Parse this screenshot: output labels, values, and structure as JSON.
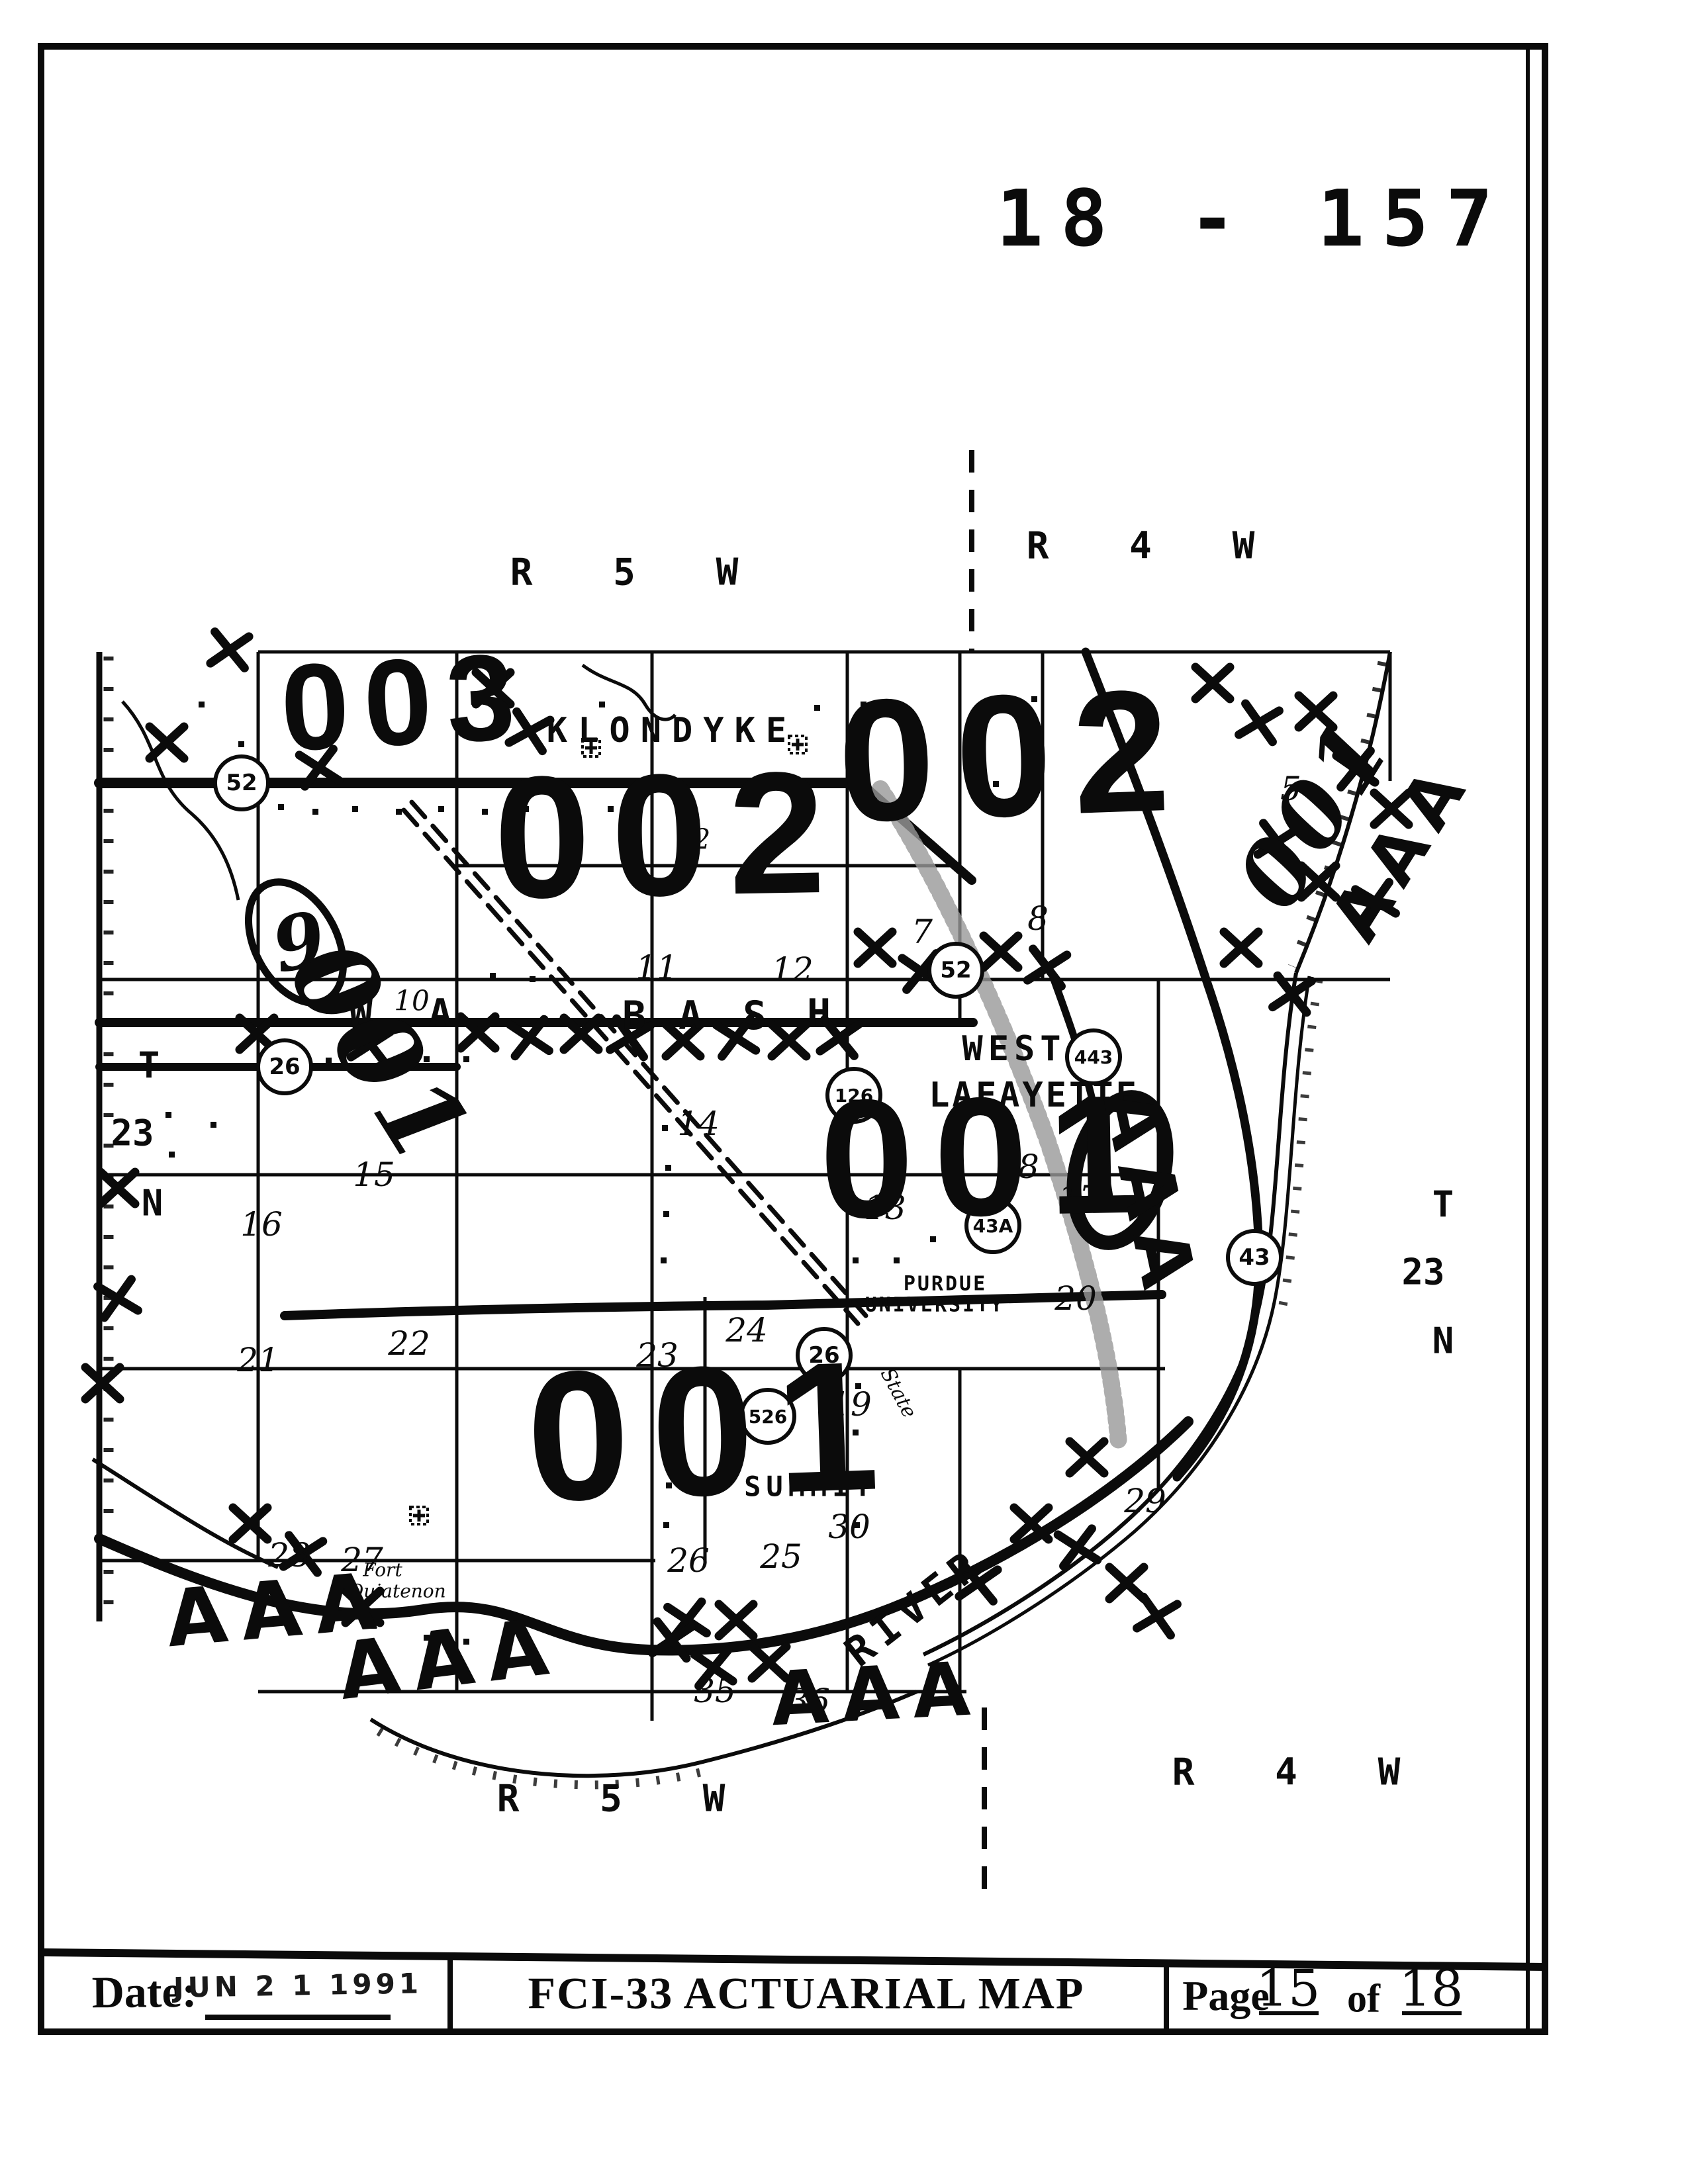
{
  "header": {
    "map_number": "18 - 157"
  },
  "map": {
    "range_labels": {
      "top_left": "R 5 W",
      "top_right": "R 4 W",
      "bottom_left": "R 5 W",
      "bottom_right": "R 4 W"
    },
    "township_left": [
      "T",
      "23",
      "N"
    ],
    "township_right": [
      "T",
      "23",
      "N"
    ],
    "zones": {
      "top_left": "003",
      "center": "002",
      "top_right": "002",
      "east": "001",
      "south": "001"
    },
    "annotations": {
      "hand_left": "001",
      "hand_right": "001",
      "aaa_sw": "AAA",
      "aaa_s": "AAA",
      "aaa_se": "AAA",
      "aaa_east": "AAA",
      "aaa_ne": "AAA",
      "circled_section": "9"
    },
    "places": {
      "klondyke": "KLONDYKE",
      "west": "WEST",
      "lafayette": "LAFAYETTE",
      "purdue": "PURDUE",
      "university": "UNIVERSITY",
      "summit": "SUMMIT",
      "river": "RIVER",
      "fort": "Fort",
      "ouiatenon": "Ouiatenon",
      "state": "State"
    },
    "wabash": [
      "W",
      "A",
      "B",
      "A",
      "S",
      "H"
    ],
    "shields": {
      "us52_w": "52",
      "us52_e": "52",
      "sr26_w": "26",
      "sr26_e": "26",
      "sr126": "126",
      "sr443": "443",
      "sr43": "43",
      "sr43a": "43A",
      "sr526": "526"
    },
    "sections": {
      "s2": "2",
      "s5": "5",
      "s6": "6",
      "s7": "7",
      "s8": "8",
      "s10": "10",
      "s11": "11",
      "s12": "12",
      "s13": "13",
      "s14": "14",
      "s15": "15",
      "s16": "16",
      "s17": "17",
      "s18": "18",
      "s19": "19",
      "s20": "20",
      "s21": "21",
      "s22": "22",
      "s23": "23",
      "s24": "24",
      "s25": "25",
      "s26": "26",
      "s27": "27",
      "s28": "28",
      "s29": "29",
      "s30": "30",
      "s35": "35",
      "s36": "36"
    }
  },
  "footer": {
    "date_label": "Date:",
    "date_stamp": "JUN 2 1 1991",
    "title": "FCI-33 ACTUARIAL MAP",
    "page_label": "Page",
    "page_number": "15",
    "of_label": "of",
    "total_pages": "18"
  }
}
